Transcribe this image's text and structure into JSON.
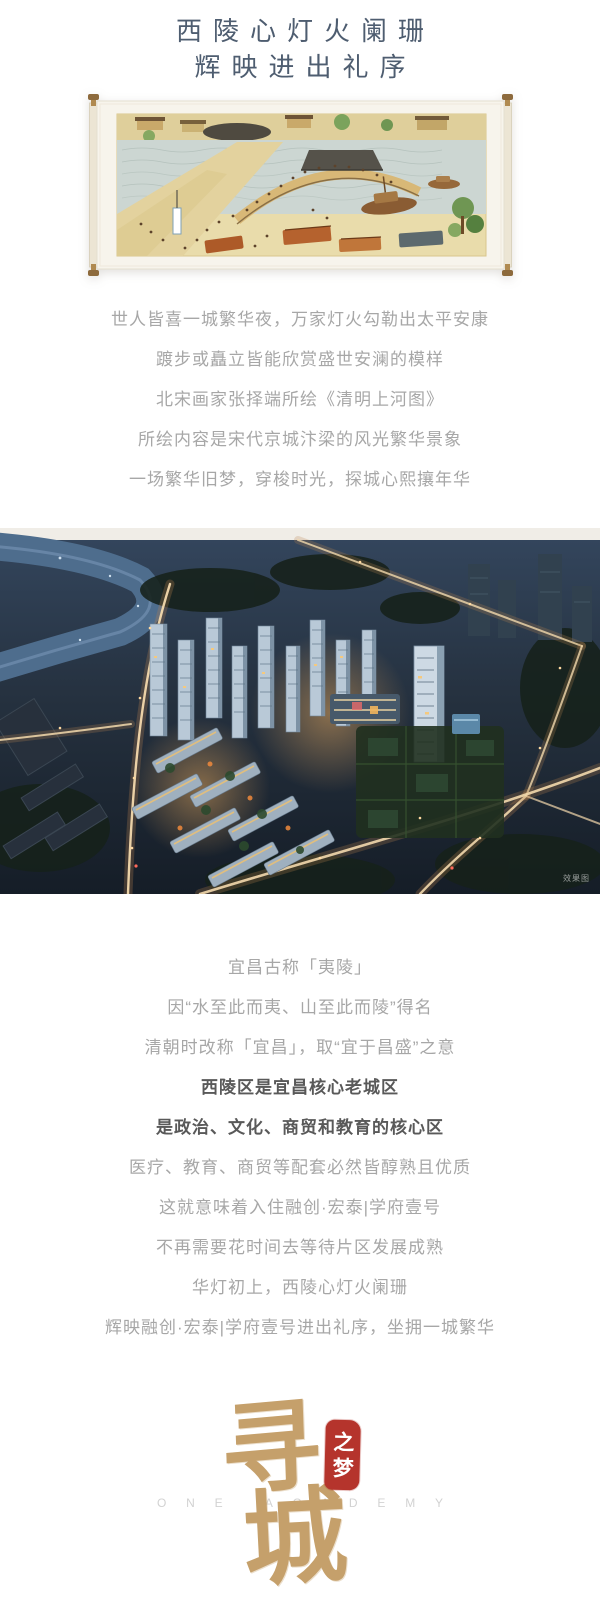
{
  "header": {
    "title_line1": "西陵心灯火阑珊",
    "title_line2": "辉映进出礼序"
  },
  "intro": {
    "lines": [
      "世人皆喜一城繁华夜，万家灯火勾勒出太平安康",
      "踱步或矗立皆能欣赏盛世安澜的模样",
      "北宋画家张择端所绘《清明上河图》",
      "所绘内容是宋代京城汴梁的风光繁华景象",
      "一场繁华旧梦，穿梭时光，探城心熙攘年华"
    ]
  },
  "aerial": {
    "watermark": "效果图"
  },
  "body": {
    "lines": [
      {
        "text": "宜昌古称「夷陵」",
        "bold": false
      },
      {
        "text": "因“水至此而夷、山至此而陵”得名",
        "bold": false
      },
      {
        "text": "清朝时改称「宜昌」，取“宜于昌盛”之意",
        "bold": false
      },
      {
        "text": "西陵区是宜昌核心老城区",
        "bold": true
      },
      {
        "text": "是政治、文化、商贸和教育的核心区",
        "bold": true
      },
      {
        "text": "医疗、教育、商贸等配套必然皆醇熟且优质",
        "bold": false
      },
      {
        "text": "这就意味着入住融创·宏泰|学府壹号",
        "bold": false
      },
      {
        "text": "不再需要花时间去等待片区发展成熟",
        "bold": false
      },
      {
        "text": "华灯初上，西陵心灯火阑珊",
        "bold": false
      },
      {
        "text": "辉映融创·宏泰|学府壹号进出礼序，坐拥一城繁华",
        "bold": false
      }
    ]
  },
  "logo": {
    "char_top": "寻",
    "char_bottom": "城",
    "seal_text": "之梦",
    "english": "ONE ACADEMY"
  },
  "colors": {
    "title": "#4e5d70",
    "body_text": "#a7a7a7",
    "body_bold": "#595959",
    "logo_tan": "#c5a06b",
    "seal_red": "#b5342c"
  }
}
